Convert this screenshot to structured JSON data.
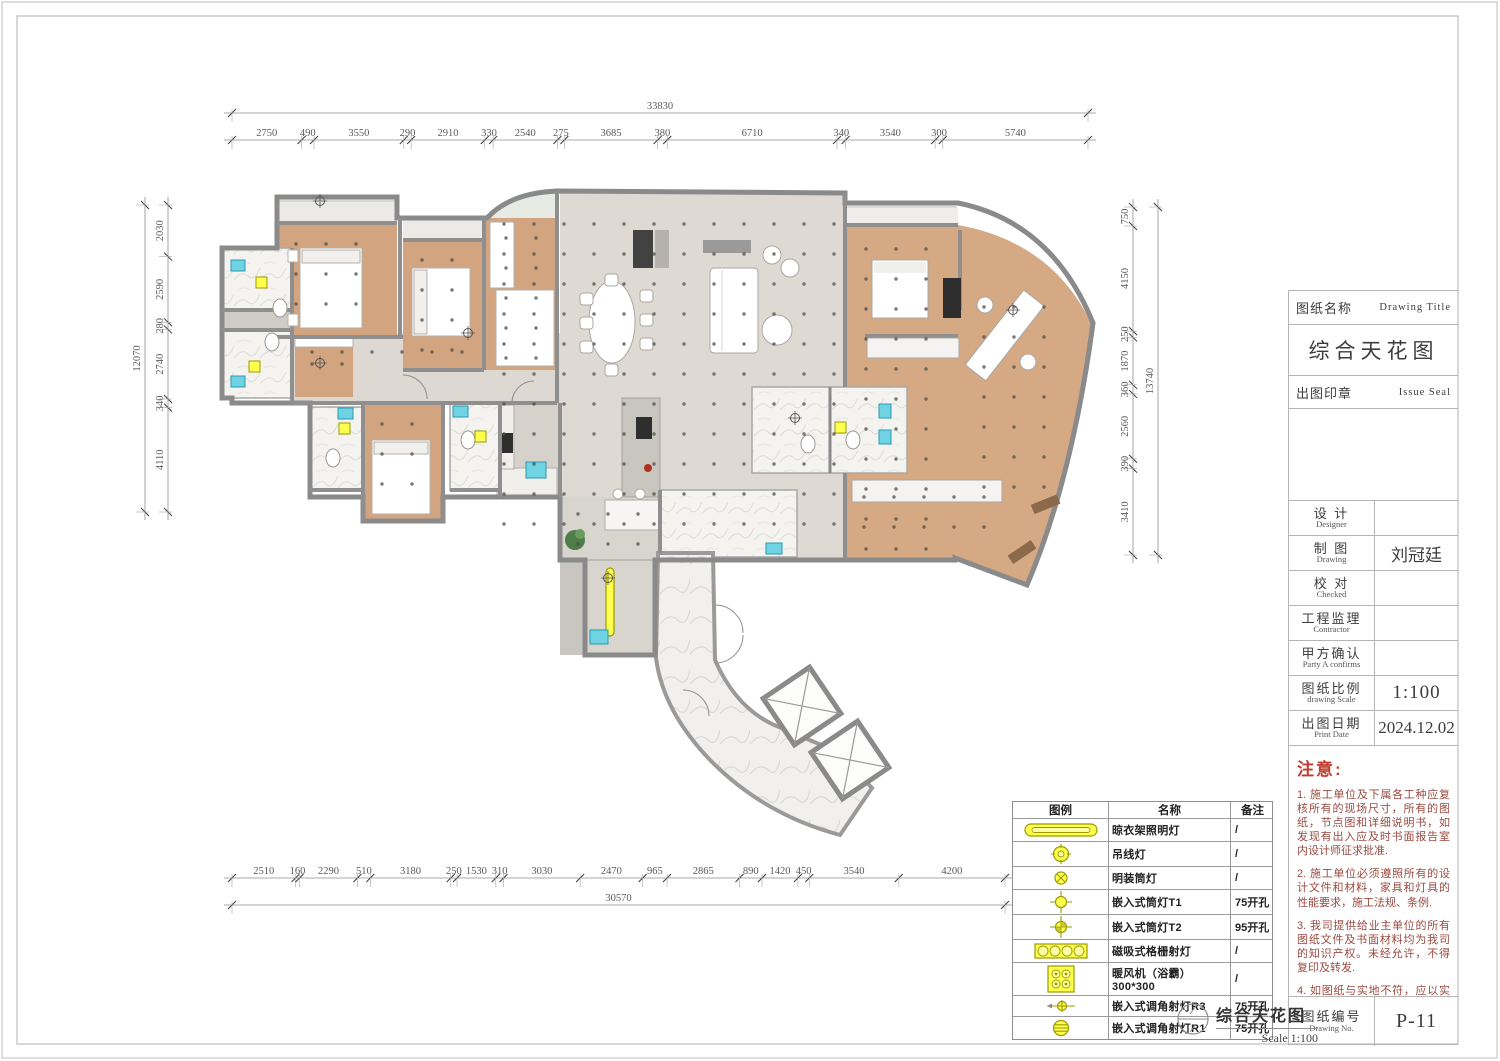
{
  "sheet": {
    "type_label": "综合天花图",
    "colors": {
      "wood_ceiling": "#d2a47f",
      "floor": "#ded9d3",
      "wall": "#8a8a8a",
      "marble": "#f4f3f0",
      "accent_yellow": "#ffff4d",
      "fixture_cyan": "#6fd3e3",
      "notes_red": "#c03a30"
    }
  },
  "dimensions": {
    "top": {
      "total": "33830",
      "segments": [
        "2750",
        "490",
        "3550",
        "290",
        "2910",
        "330",
        "2540",
        "275",
        "3685",
        "380",
        "6710",
        "340",
        "3540",
        "300",
        "5740"
      ]
    },
    "bottom": {
      "total": "30570",
      "segments": [
        "2510",
        "160",
        "2290",
        "510",
        "3180",
        "250",
        "1530",
        "310",
        "3030",
        "2470",
        "965",
        "2865",
        "890",
        "1420",
        "450",
        "3540",
        "4200"
      ]
    },
    "left": {
      "total": "12070",
      "segments": [
        "2030",
        "2590",
        "280",
        "2740",
        "340",
        "4110"
      ]
    },
    "right": {
      "total": "13740",
      "segments": [
        "750",
        "4150",
        "250",
        "1870",
        "360",
        "2560",
        "390",
        "3410"
      ]
    }
  },
  "title_block": {
    "name_label_cn": "图纸名称",
    "name_label_en": "Drawing Title",
    "drawing_title": "综合天花图",
    "seal_label_cn": "出图印章",
    "seal_label_en": "Issue Seal",
    "rows": [
      {
        "cn": "设 计",
        "en": "Designer",
        "value": ""
      },
      {
        "cn": "制 图",
        "en": "Drawing",
        "value": "刘冠廷"
      },
      {
        "cn": "校 对",
        "en": "Checked",
        "value": ""
      },
      {
        "cn": "工程监理",
        "en": "Contractor",
        "value": ""
      },
      {
        "cn": "甲方确认",
        "en": "Party A confirms",
        "value": ""
      },
      {
        "cn": "图纸比例",
        "en": "drawing Scale",
        "value": "1:100"
      },
      {
        "cn": "出图日期",
        "en": "Print Date",
        "value": "2024.12.02"
      }
    ],
    "notes_title": "注意:",
    "notes": [
      "1. 施工单位及下属各工种应复核所有的现场尺寸，所有的图纸，节点图和详细说明书，如发现有出入应及时书面报告室内设计师征求批准.",
      "2. 施工单位必须遵照所有的设计文件和材料，家具和灯具的性能要求，施工法规、条例.",
      "3. 我司提供给业主单位的所有图纸文件及书面材料均为我司的知识产权。未经允许，不得复印及转发.",
      "4. 如图纸与实地不符，应以实地尺寸为准作相应调整."
    ],
    "drawing_no_cn": "图纸编号",
    "drawing_no_en": "Drawing No.",
    "drawing_no": "P-11"
  },
  "legend": {
    "headers": [
      "图例",
      "名称",
      "备注"
    ],
    "rows": [
      {
        "icon": "drying-rack-light-icon",
        "name": "晾衣架照明灯",
        "note": "/"
      },
      {
        "icon": "pendant-light-icon",
        "name": "吊线灯",
        "note": "/"
      },
      {
        "icon": "surface-downlight-icon",
        "name": "明装筒灯",
        "note": "/"
      },
      {
        "icon": "recessed-downlight-t1-icon",
        "name": "嵌入式筒灯T1",
        "note": "75开孔"
      },
      {
        "icon": "recessed-downlight-t2-icon",
        "name": "嵌入式筒灯T2",
        "note": "95开孔"
      },
      {
        "icon": "magnetic-grille-light-icon",
        "name": "磁吸式格栅射灯",
        "note": "/"
      },
      {
        "icon": "bathroom-heater-icon",
        "name": "暖风机（浴霸）300*300",
        "note": "/"
      },
      {
        "icon": "adjustable-spot-r3-icon",
        "name": "嵌入式调角射灯R3",
        "note": "75开孔"
      },
      {
        "icon": "adjustable-spot-r1-icon",
        "name": "嵌入式调角射灯R1",
        "note": "75开孔"
      }
    ]
  },
  "footer": {
    "drawing_title": "综合天花图",
    "scale": "Scale 1:100"
  }
}
